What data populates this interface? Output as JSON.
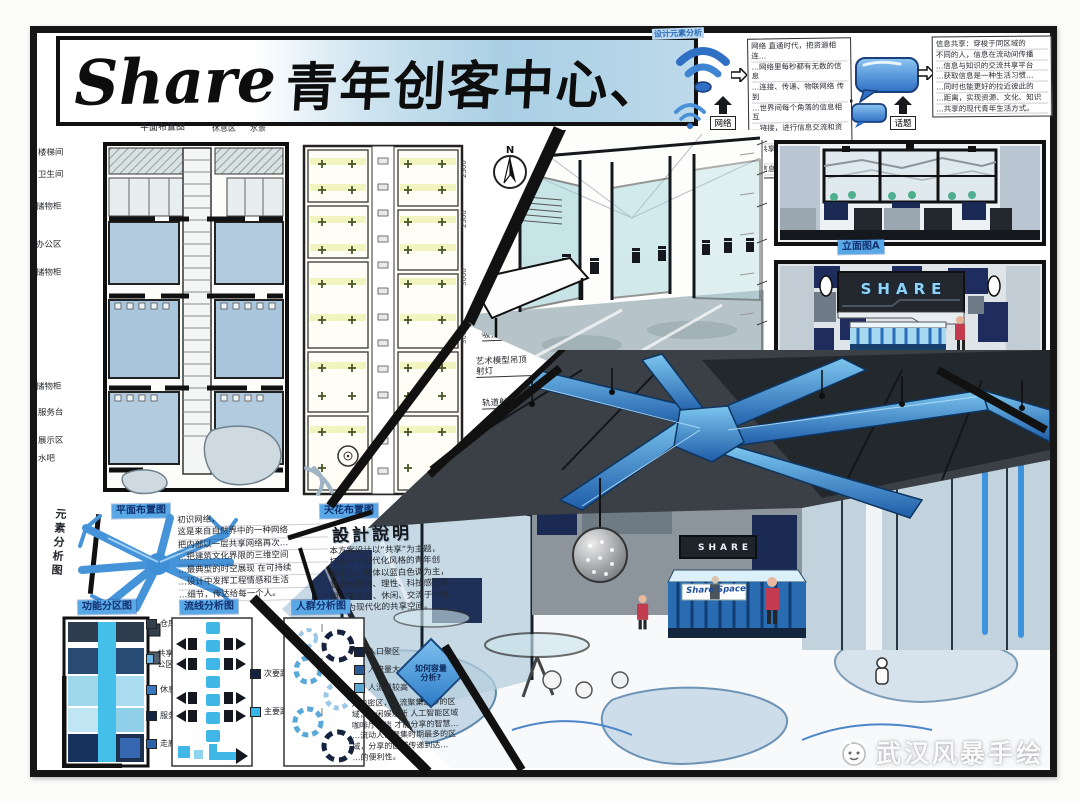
{
  "board": {
    "title_en": "Share",
    "title_cn": "青年创客中心、",
    "corner_label": "设计元素分析",
    "north_label": "N",
    "watermark": "武汉风暴手绘"
  },
  "concept": {
    "network": {
      "caption": "网络",
      "notes": [
        "网络 直通时代，把资源相连…",
        "…网络里每秒都有无数的信息",
        "…连接、传递、物联网络 传到",
        "…世界间每个角落的信息相互",
        "…链接，进行信息交流和资源",
        "…共享，是当今最快捷的传递",
        "…信息的重要手段。"
      ]
    },
    "topic": {
      "caption": "话题",
      "notes": [
        "信息共享：穿梭于同区域的",
        "不同的人，信息在流动间传播",
        "…信息与知识的交流共享平台",
        "…获取信息是一种生活习惯…",
        "…同时也能更好的拉近彼此的",
        "…距离，实现资源、文化、知识",
        "…共享的现代青年生活方式。"
      ]
    }
  },
  "floor_plan": {
    "top_title": "平面布置图",
    "top_labels": [
      "休息区",
      "水景"
    ],
    "rooms": [
      "楼梯间",
      "卫生间",
      "储物柜",
      "办公区",
      "储物柜",
      "储物柜",
      "服务台",
      "展示区",
      "水吧"
    ],
    "dims": [
      "2400",
      "3600",
      "3000",
      "6000",
      "4000"
    ],
    "title": "平面布置图"
  },
  "ceiling_plan": {
    "title": "天花布置图",
    "scale": "1:75",
    "lights": [
      "长条形灯",
      "吸顶灯",
      "艺术模型吊顶 射灯",
      "轨道射灯"
    ],
    "dims": [
      "2500",
      "2500",
      "3000",
      "3000",
      "20000"
    ]
  },
  "elevations": {
    "a_label": "立面图A",
    "b_label": "立面图B",
    "b_scale": "1:75",
    "sign": "SHARE",
    "annotations": [
      "蓝色元素符号",
      "艺术造型吊顶"
    ]
  },
  "perspective": {
    "sign": "SHARE",
    "counter": "Share Space"
  },
  "analysis": {
    "vertical_label": "元素分析图",
    "concept_notes": [
      "初识网络，",
      "这是来自自然界中的一种网络",
      "把内部以一层共享网络再次…",
      "…把建筑文化界限的三维空间",
      "…最典型的时空展现 在可持续",
      "…设计中发挥工程情感和生活",
      "…细节，传达给每一个人。"
    ],
    "design_title": "設計說明",
    "design_notes": [
      "本方案设计以“共享”为主题，",
      "打造一个现代化风格的青年创",
      "客中心。整体以蓝白色调为主，",
      "营造出简洁、理性、科技感的氛",
      "围，集办公、休闲、交流于一体，",
      "是更为现代化的共享空间。"
    ],
    "zoning": {
      "title": "功能分区图",
      "legend": [
        "仓库",
        "共享办公区",
        "休息大厅",
        "服务前台",
        "走廊"
      ]
    },
    "circulation": {
      "title": "流线分析图",
      "legend": [
        "次要路线",
        "主要路线"
      ]
    },
    "crowd": {
      "title": "人群分析图",
      "legend": [
        "入口聚区",
        "人流量大",
        "人流量较高"
      ],
      "notes": [
        "入口密区，人流聚集最多的区",
        "域，休闲娱乐所 人工智能区域",
        "咖啡厅洽谈 才能分享的智慧…",
        "…流动人口聚集时期最多的区",
        "域，分享的区域传递到达…",
        "…的便利性。"
      ],
      "diamond_l1": "如何容量",
      "diamond_l2": "分析?"
    }
  }
}
